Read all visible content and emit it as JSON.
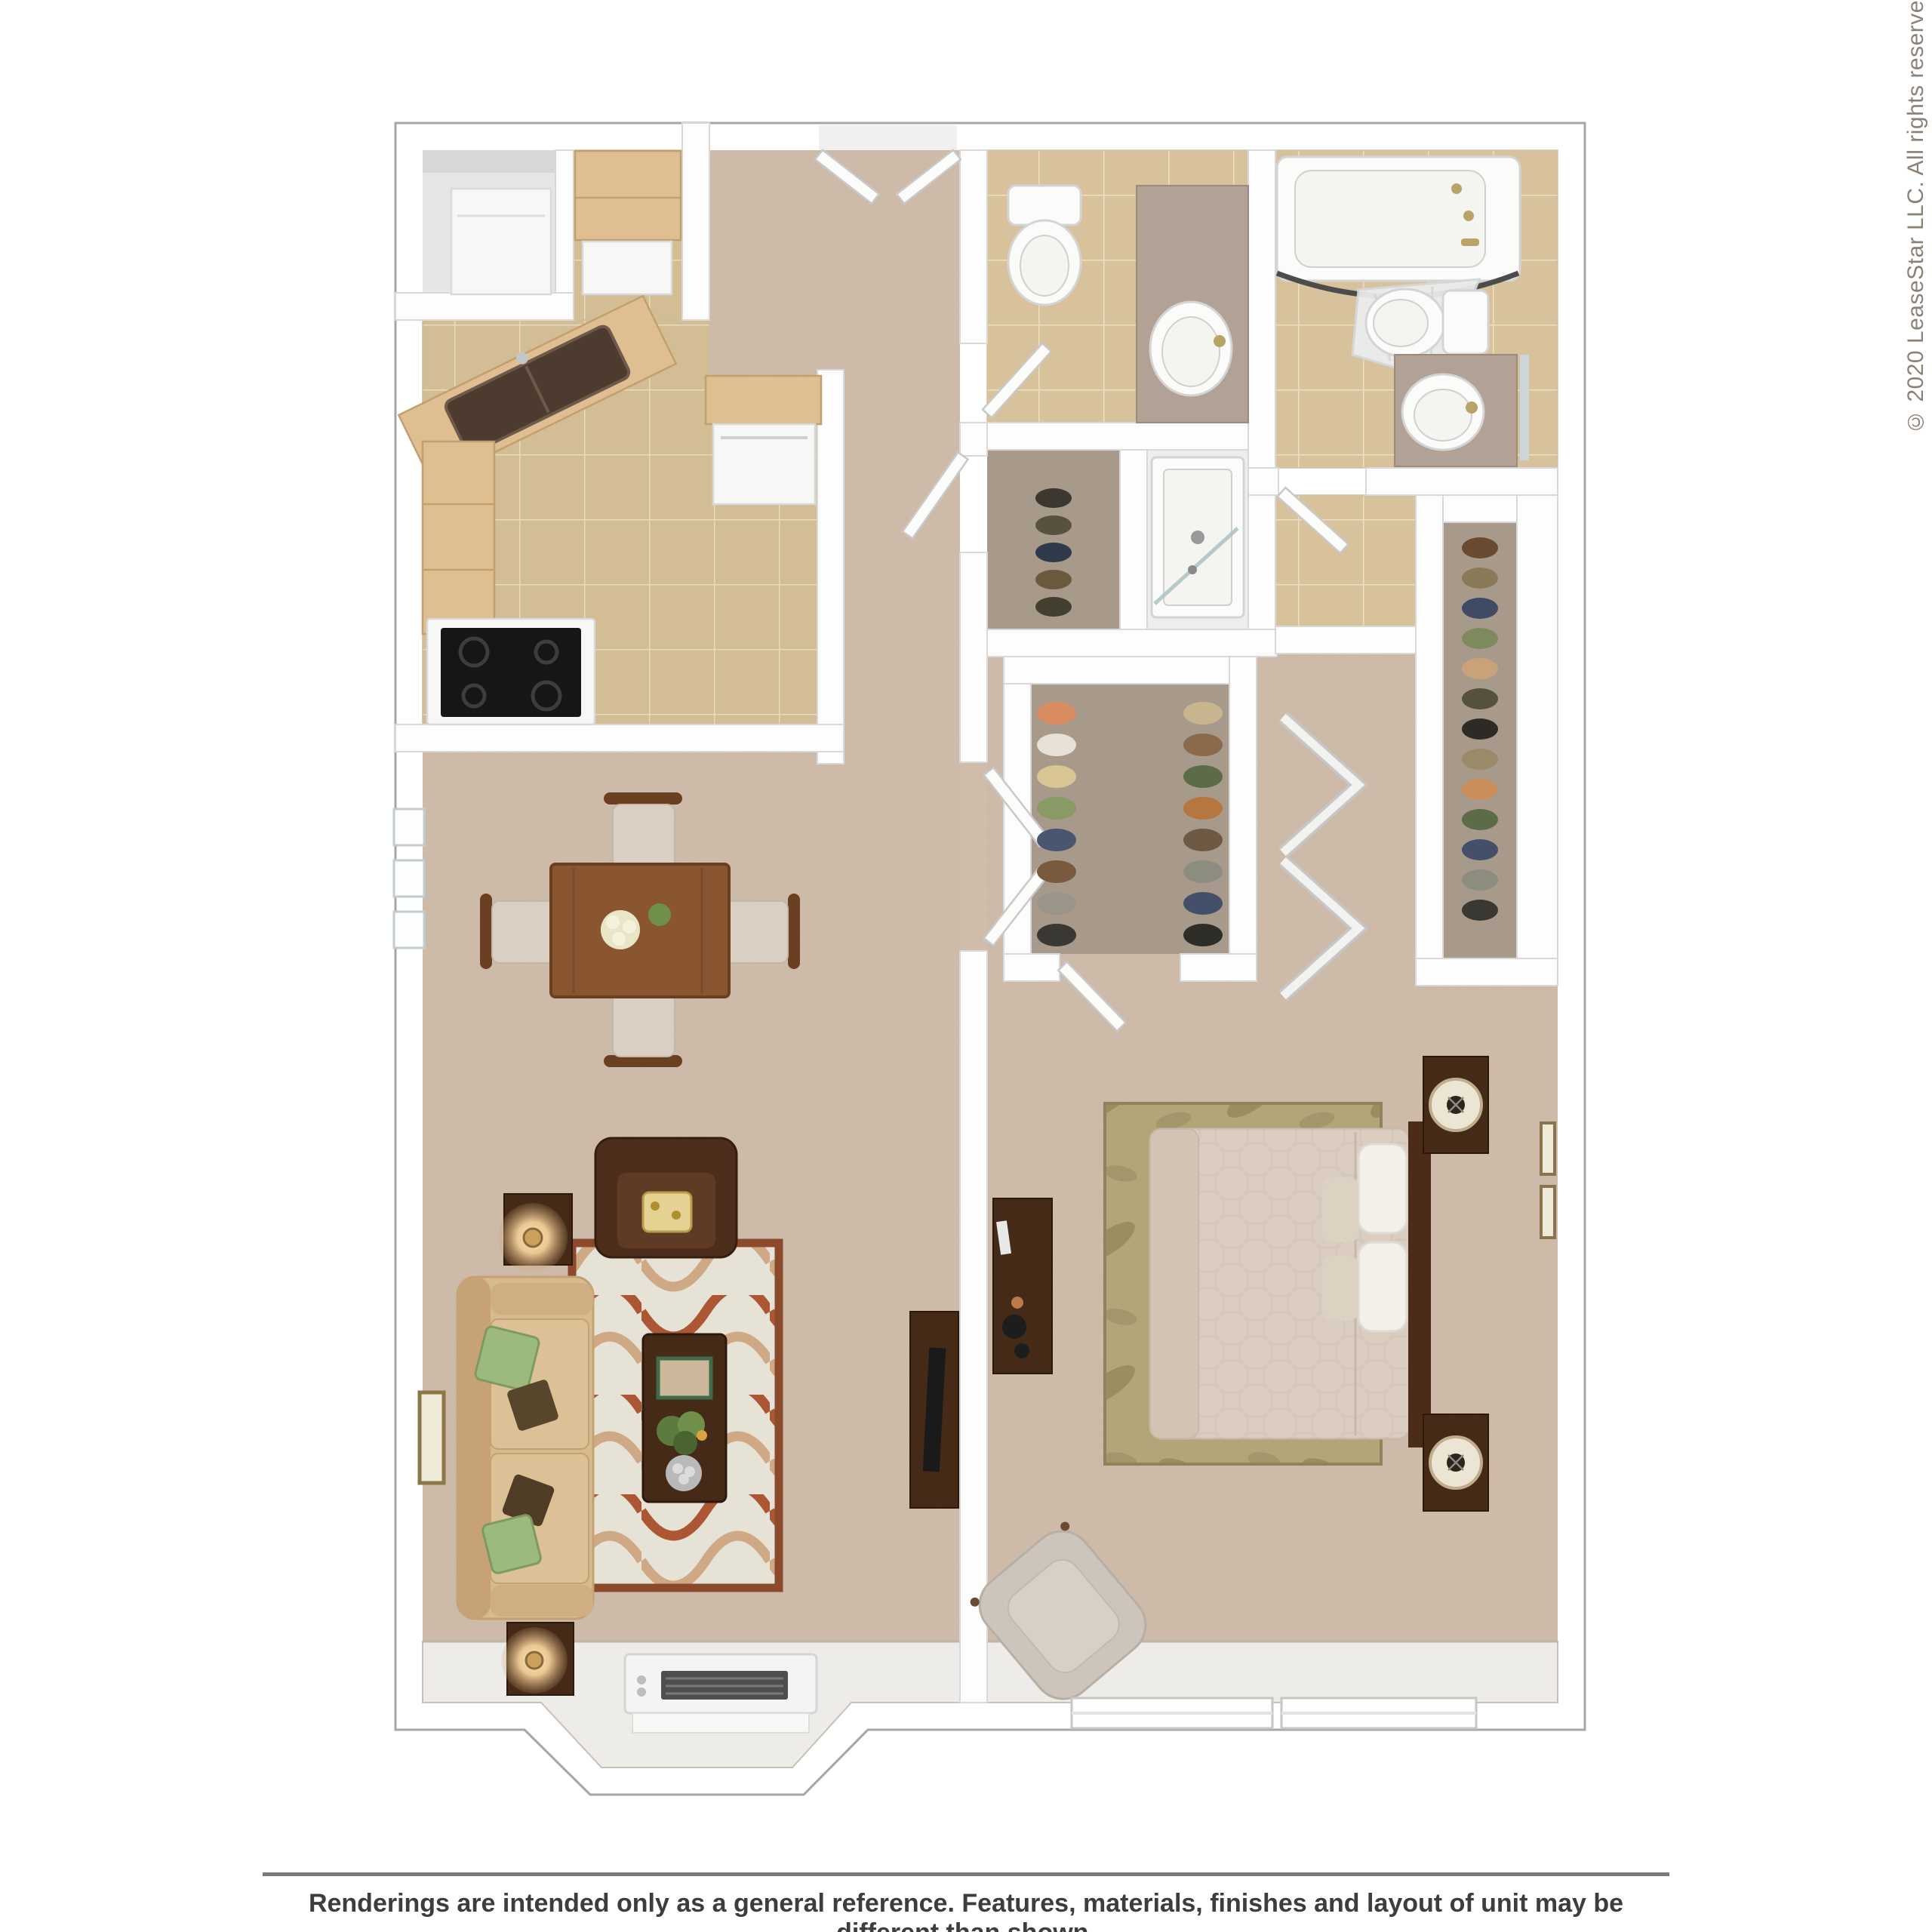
{
  "meta": {
    "copyright": "© 2020 LeaseStar LLC. All rights reserved.",
    "disclaimer": "Renderings are intended only as a general reference. Features, materials, finishes and layout of unit may be different than shown."
  },
  "palette": {
    "wallStroke": "#a6a6a6",
    "carpet": "#cfbcaa",
    "sill": "#edece9",
    "tileKitchen": "#d3bd95",
    "tileBath": "#d8c29c",
    "grout": "#e8dbbd",
    "oak": "#dfbf92",
    "walnut": "#8a5531",
    "darkWood": "#452a17",
    "sofa": "#d8ba8f",
    "leather": "#4d2d1c",
    "mauve": "#b2a195",
    "rugCream": "#e7e2d6",
    "rugRust": "#ad5634",
    "rugTan": "#cfa885",
    "bedroomRug": "#b2a577",
    "comforter": "#dbcdbf",
    "accentGreen": "#9cb97e",
    "lampGlow": "#ecc793",
    "textDark": "#3d3d3d",
    "rule": "#7b7b7b",
    "copyright": "#8c8177"
  },
  "closets": {
    "walkin_left": [
      "#d98c5f",
      "#e8e2d6",
      "#d9c594",
      "#8a9a64",
      "#4a5570",
      "#7a5a3f",
      "#9a9588",
      "#3a3833"
    ],
    "walkin_right": [
      "#c9b490",
      "#8a6a4a",
      "#5c6b48",
      "#b5763f",
      "#6e5a44",
      "#8d8d7f",
      "#44506a",
      "#2f2d28"
    ],
    "right_closet": [
      "#6b4a32",
      "#8a7a5a",
      "#3f4a63",
      "#7e8a5e",
      "#caa27a",
      "#56503f",
      "#2e2b26",
      "#9a8a6a",
      "#c98e5a",
      "#5c6b48",
      "#44506a",
      "#8d8d7f",
      "#3a3833"
    ],
    "subcloset": [
      "#3c3830",
      "#57513f",
      "#2f3a4a",
      "#6b5a3f",
      "#44402f"
    ]
  }
}
